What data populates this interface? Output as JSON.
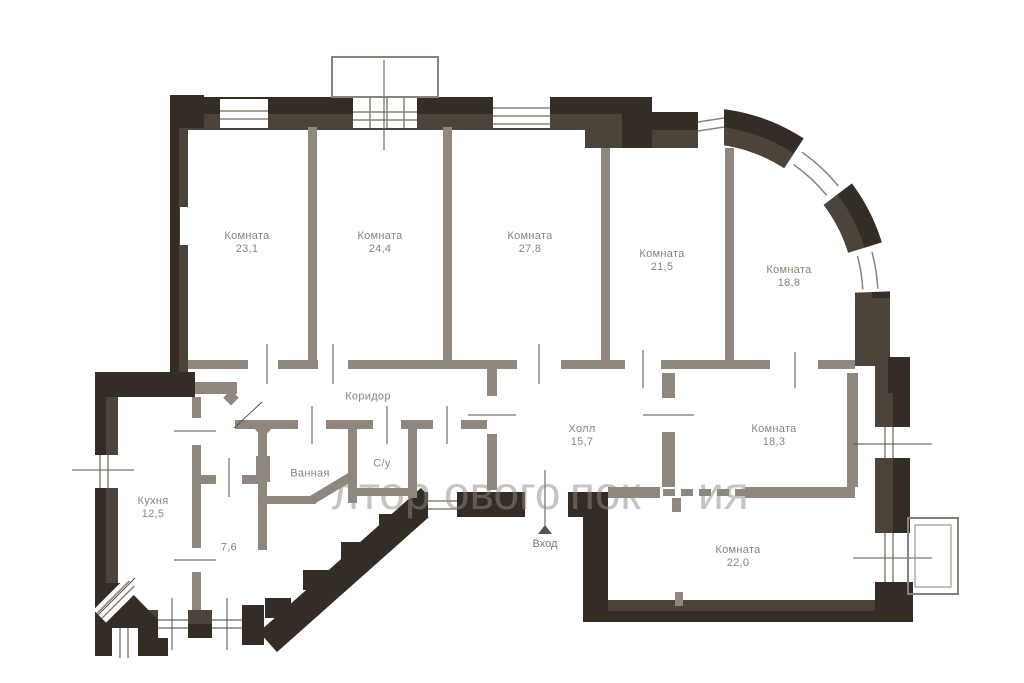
{
  "plan": {
    "rooms": [
      {
        "id": "room-23-1",
        "name": "Комната",
        "area": "23,1"
      },
      {
        "id": "room-24-4",
        "name": "Комната",
        "area": "24,4"
      },
      {
        "id": "room-27-8",
        "name": "Комната",
        "area": "27,8"
      },
      {
        "id": "room-21-5",
        "name": "Комната",
        "area": "21,5"
      },
      {
        "id": "room-18-8",
        "name": "Комната",
        "area": "18,8"
      },
      {
        "id": "corridor",
        "name": "Коридор",
        "area": ""
      },
      {
        "id": "hall",
        "name": "Холл",
        "area": "15,7"
      },
      {
        "id": "room-18-3",
        "name": "Комната",
        "area": "18,3"
      },
      {
        "id": "room-22-0",
        "name": "Комната",
        "area": "22,0"
      },
      {
        "id": "kitchen",
        "name": "Кухня",
        "area": "12,5"
      },
      {
        "id": "room-7-6",
        "name": "",
        "area": "7,6"
      },
      {
        "id": "bathroom",
        "name": "Ванная",
        "area": ""
      },
      {
        "id": "wc",
        "name": "С/у",
        "area": ""
      }
    ],
    "entrance": {
      "label": "Вход"
    },
    "watermark": {
      "fragments": [
        "лтор",
        "ового",
        "пок",
        "ия"
      ]
    },
    "colors": {
      "wall_dark": "#332d26",
      "wall_mid": "#4c443a",
      "wall_interior": "#8f877d",
      "label_text": "#8b8379",
      "watermark_text": "#918a82",
      "background": "#ffffff"
    }
  }
}
